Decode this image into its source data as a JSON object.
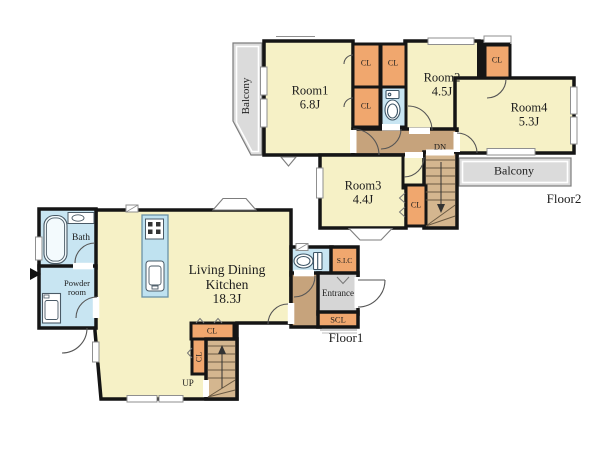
{
  "floor2": {
    "floor_label": "Floor2",
    "balcony_left": "Balcony",
    "balcony_right": "Balcony",
    "stairs_label": "DN",
    "room1": {
      "name": "Room1",
      "size": "6.8J"
    },
    "room2": {
      "name": "Room2",
      "size": "4.5J"
    },
    "room3": {
      "name": "Room3",
      "size": "4.4J"
    },
    "room4": {
      "name": "Room4",
      "size": "5.3J"
    },
    "cl1": "CL",
    "cl2": "CL",
    "cl3": "CL",
    "cl4": "CL",
    "cl5": "CL"
  },
  "floor1": {
    "floor_label": "Floor1",
    "stairs_label": "UP",
    "ldk": {
      "name_line1": "Living Dining",
      "name_line2": "Kitchen",
      "size": "18.3J"
    },
    "bath": "Bath",
    "powder_line1": "Powder",
    "powder_line2": "room",
    "entrance": "Entrance",
    "sic": "S.I.C",
    "scl": "SCL",
    "cl1": "CL",
    "cl2": "CL"
  },
  "colors": {
    "room_fill": "#F6F1C6",
    "closet_fill": "#F0A76E",
    "wet_area_fill": "#C8E5F2",
    "hallway_fill": "#C6A37C",
    "stairs_fill": "#D4B68F",
    "balcony_fill": "#DBDBDB",
    "entrance_fill": "#D6D6D6",
    "wall": "#151515"
  },
  "icons": {
    "toilet_floor2": "toilet-icon",
    "toilet_floor1": "toilet-icon",
    "bathtub": "bathtub-icon",
    "vanity": "sink-icon",
    "washing_machine": "washing-machine-icon",
    "stove": "stove-icon",
    "kitchen_sink": "sink-icon"
  }
}
